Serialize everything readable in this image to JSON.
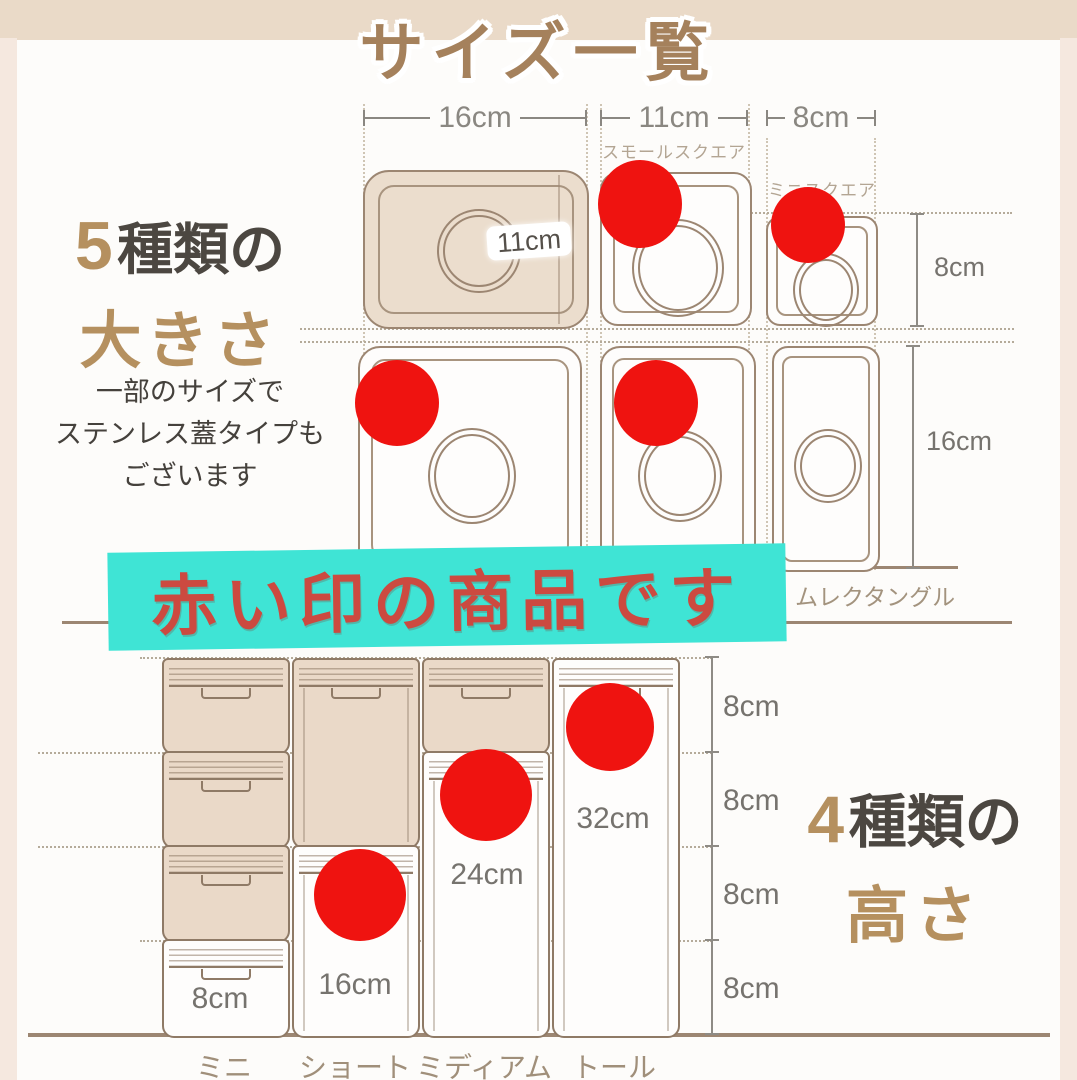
{
  "title": "サイズ一覧",
  "colors": {
    "accent_red": "#ef1310",
    "banner_bg": "#3fe4d5",
    "banner_text": "#cc4a40",
    "brown_accent": "#b5905f",
    "outline_tan": "#9c8672"
  },
  "size_section": {
    "count": "5",
    "count_suffix": "種類の",
    "subject": "大きさ",
    "note_line1": "一部のサイズで",
    "note_line2": "ステンレス蓋タイプも",
    "note_line3": "ございます",
    "width_16": "16cm",
    "width_11": "11cm",
    "width_8": "8cm",
    "label_small_square": "スモールスクエア",
    "label_mini_square": "ミニスクエア",
    "label_slim_rectangle": "ムレクタングル",
    "lid_diameter": "11cm",
    "square_height": "8cm",
    "rect_height": "16cm"
  },
  "banner": {
    "text": "赤い印の商品です"
  },
  "height_section": {
    "count": "4",
    "count_suffix": "種類の",
    "subject": "高さ",
    "unit_ticks": [
      "8cm",
      "8cm",
      "8cm",
      "8cm"
    ],
    "height_mini": "8cm",
    "height_short": "16cm",
    "height_medium": "24cm",
    "height_tall": "32cm",
    "col_mini": "ミニ",
    "col_short": "ショート",
    "col_medium": "ミディアム",
    "col_tall": "トール"
  }
}
